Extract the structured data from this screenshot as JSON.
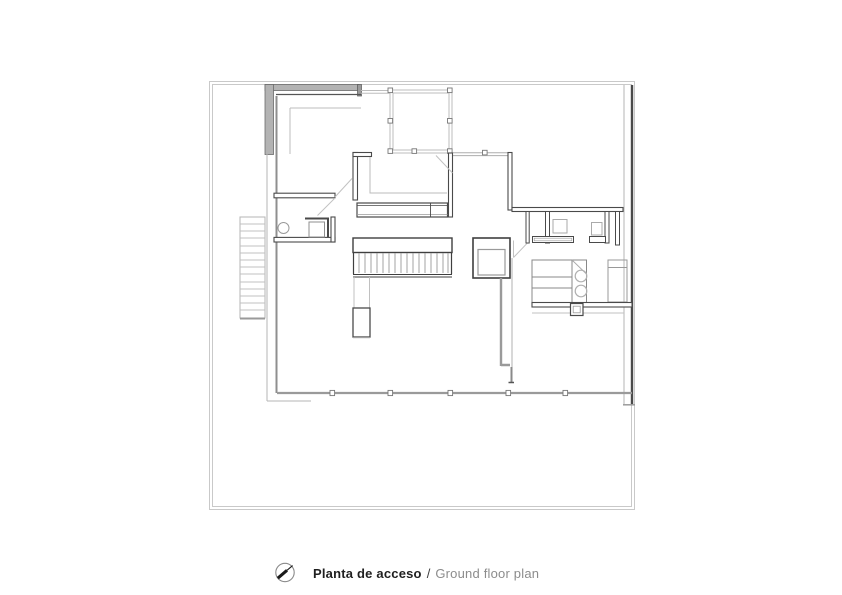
{
  "caption": {
    "title_primary": "Planta de acceso",
    "separator": "/",
    "title_secondary": "Ground floor plan"
  },
  "icons": {
    "north_arrow": "north-arrow-icon"
  },
  "colors": {
    "background": "#ffffff",
    "wall_dark": "#454545",
    "wall_mid": "#9a9a9a",
    "wall_fill": "#b3b3b3",
    "line_light": "#c6c6c6",
    "caption_primary": "#1f1f1f",
    "caption_separator": "#3c3c3c",
    "caption_secondary": "#8c8c8c"
  }
}
